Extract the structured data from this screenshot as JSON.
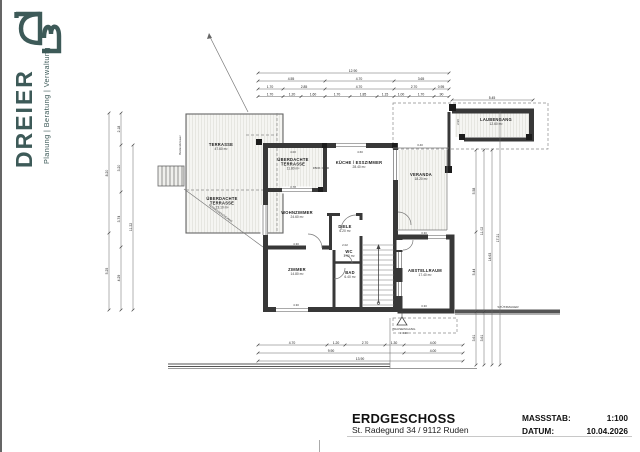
{
  "branding": {
    "name": "DREIER",
    "tagline": "Planung | Beratung | Verwaltung",
    "logo_monogram": "D3",
    "accent_color": "#3d5a58"
  },
  "titleblock": {
    "title": "ERDGESCHOSS",
    "address": "St. Radegund 34 / 9112 Ruden",
    "scale_label": "MASSSTAB:",
    "scale_value": "1:100",
    "date_label": "DATUM:",
    "date_value": "10.04.2026"
  },
  "colors": {
    "wall_line": "#383838",
    "dim_line": "#666666",
    "deck_fill": "#f5f5f2"
  },
  "plan": {
    "rooms": [
      {
        "lines": [
          "TERRASSE"
        ],
        "area": "47.60 m²",
        "x": 221,
        "y": 146
      },
      {
        "lines": [
          "ÜBERDACHTE",
          "TERRASSE"
        ],
        "area": "23.10 m²",
        "x": 222,
        "y": 200
      },
      {
        "lines": [
          "ÜBERDACHTE",
          "TERRASSE"
        ],
        "area": "11.80 m²",
        "x": 293,
        "y": 161
      },
      {
        "lines": [
          "KÜCHE / ESSZIMMER"
        ],
        "area": "28.40 m²",
        "x": 359,
        "y": 164
      },
      {
        "lines": [
          "VERANDA"
        ],
        "area": "18.20 m²",
        "x": 421,
        "y": 176
      },
      {
        "lines": [
          "LAUBENGANG"
        ],
        "area": "12.60 m²",
        "x": 496,
        "y": 121
      },
      {
        "lines": [
          "WOHNZIMMER"
        ],
        "area": "24.60 m²",
        "x": 297,
        "y": 214
      },
      {
        "lines": [
          "DIELE"
        ],
        "area": "6.20 m²",
        "x": 345,
        "y": 228
      },
      {
        "lines": [
          "ZIMMER"
        ],
        "area": "14.80 m²",
        "x": 297,
        "y": 271
      },
      {
        "lines": [
          "WC"
        ],
        "area": "1.90 m²",
        "x": 349,
        "y": 253
      },
      {
        "lines": [
          "BAD"
        ],
        "area": "6.40 m²",
        "x": 350,
        "y": 274
      },
      {
        "lines": [
          "ABSTELLRAUM"
        ],
        "area": "17.40 m²",
        "x": 425,
        "y": 272
      }
    ],
    "labels": [
      {
        "t": "4.00",
        "x": 293,
        "y": 153,
        "size": 2.9
      },
      {
        "t": "4.60",
        "x": 360,
        "y": 153,
        "size": 2.9
      },
      {
        "t": "3.78",
        "x": 293,
        "y": 188,
        "size": 2.9
      },
      {
        "t": "4.30",
        "x": 296,
        "y": 245,
        "size": 2.9
      },
      {
        "t": "4.30",
        "x": 296,
        "y": 306,
        "size": 2.9
      },
      {
        "t": "2.02",
        "x": 345,
        "y": 246,
        "size": 2.9
      },
      {
        "t": "3.30",
        "x": 424,
        "y": 234,
        "size": 2.9
      },
      {
        "t": "3.30",
        "x": 424,
        "y": 307,
        "size": 2.9
      },
      {
        "t": "3.40",
        "x": 420,
        "y": 146,
        "size": 2.9
      },
      {
        "t": "2.96",
        "x": 459,
        "y": 122,
        "rot": -90,
        "size": 2.9
      },
      {
        "t": "STÜTZMAUER",
        "x": 508,
        "y": 308,
        "size": 3.1
      },
      {
        "t": "HAUSEINGANG",
        "x": 404,
        "y": 330,
        "size": 3.1
      },
      {
        "t": "± 0.00",
        "x": 404,
        "y": 334,
        "size": 2.9
      },
      {
        "t": "FBOK ± 0.00",
        "x": 321,
        "y": 169,
        "size": 2.8
      },
      {
        "t": "Bestandsmauer",
        "x": 181,
        "y": 145,
        "rot": -90,
        "size": 2.8
      },
      {
        "t": "TERRASSENZUGANG",
        "x": 220,
        "y": 214,
        "rot": 36,
        "size": 2.8
      }
    ],
    "dim_rows": [
      {
        "y": 73,
        "x1": 258,
        "x2": 449,
        "ticks": [
          258,
          449
        ],
        "labels": [
          {
            "t": "12.90",
            "x": 353
          }
        ]
      },
      {
        "y": 81,
        "x1": 258,
        "x2": 449,
        "ticks": [
          258,
          325,
          394,
          449
        ],
        "labels": [
          {
            "t": "4.55",
            "x": 291
          },
          {
            "t": "4.70",
            "x": 359
          },
          {
            "t": "3.65",
            "x": 421
          }
        ]
      },
      {
        "y": 89,
        "x1": 258,
        "x2": 449,
        "ticks": [
          258,
          283,
          325,
          394,
          434,
          449
        ],
        "labels": [
          {
            "t": "1.70",
            "x": 270
          },
          {
            "t": "2.85",
            "x": 304
          },
          {
            "t": "4.70",
            "x": 359
          },
          {
            "t": "2.70",
            "x": 414
          },
          {
            "t": "0.95",
            "x": 441
          }
        ]
      },
      {
        "y": 96.5,
        "x1": 258,
        "x2": 449,
        "ticks": [
          258,
          283,
          301,
          325,
          350,
          377,
          394,
          409,
          434,
          449
        ],
        "labels": [
          {
            "t": "1.70",
            "x": 270
          },
          {
            "t": "1.20",
            "x": 292
          },
          {
            "t": "1.60",
            "x": 313
          },
          {
            "t": "1.70",
            "x": 337
          },
          {
            "t": "1.85",
            "x": 363
          },
          {
            "t": "1.15",
            "x": 385
          },
          {
            "t": "1.00",
            "x": 401
          },
          {
            "t": "1.70",
            "x": 421
          },
          {
            "t": ".90",
            "x": 441
          }
        ]
      },
      {
        "y": 100,
        "x1": 452,
        "x2": 533,
        "ticks": [
          452,
          533
        ],
        "labels": [
          {
            "t": "5.45",
            "x": 492
          }
        ]
      },
      {
        "y": 345,
        "x1": 258,
        "x2": 463,
        "ticks": [
          258,
          327,
          345,
          385,
          404,
          463
        ],
        "labels": [
          {
            "t": "4.70",
            "x": 292
          },
          {
            "t": "1.20",
            "x": 336
          },
          {
            "t": "2.70",
            "x": 365
          },
          {
            "t": "1.30",
            "x": 394
          },
          {
            "t": "4.00",
            "x": 433
          }
        ]
      },
      {
        "y": 353,
        "x1": 258,
        "x2": 463,
        "ticks": [
          258,
          404,
          463
        ],
        "labels": [
          {
            "t": "9.90",
            "x": 331
          },
          {
            "t": "4.00",
            "x": 433
          }
        ]
      },
      {
        "y": 361,
        "x1": 258,
        "x2": 463,
        "ticks": [
          258,
          463
        ],
        "labels": [
          {
            "t": "13.90",
            "x": 360
          }
        ]
      }
    ],
    "dim_cols": [
      {
        "x": 109,
        "y1": 113,
        "y2": 310,
        "ticks": [
          113,
          233,
          310
        ],
        "labels": [
          {
            "t": "8.20",
            "y": 173
          },
          {
            "t": "5.25",
            "y": 271
          }
        ]
      },
      {
        "x": 121,
        "y1": 113,
        "y2": 310,
        "ticks": [
          113,
          145,
          192,
          247,
          310
        ],
        "labels": [
          {
            "t": "2.18",
            "y": 129
          },
          {
            "t": "3.20",
            "y": 168
          },
          {
            "t": "3.74",
            "y": 219
          },
          {
            "t": "4.29",
            "y": 278
          }
        ]
      },
      {
        "x": 133,
        "y1": 145,
        "y2": 310,
        "ticks": [
          145,
          310
        ],
        "labels": [
          {
            "t": "11.22",
            "y": 227
          }
        ]
      },
      {
        "x": 476,
        "y1": 150,
        "y2": 365,
        "ticks": [
          150,
          232,
          312,
          365
        ],
        "labels": [
          {
            "t": "5.58",
            "y": 191
          },
          {
            "t": "5.44",
            "y": 272
          },
          {
            "t": "3.61",
            "y": 338
          }
        ]
      },
      {
        "x": 484,
        "y1": 150,
        "y2": 365,
        "ticks": [
          150,
          312,
          365
        ],
        "labels": [
          {
            "t": "11.02",
            "y": 231
          },
          {
            "t": "3.61",
            "y": 338
          }
        ]
      },
      {
        "x": 492,
        "y1": 150,
        "y2": 365,
        "ticks": [
          150,
          365
        ],
        "labels": [
          {
            "t": "14.63",
            "y": 257
          }
        ]
      },
      {
        "x": 500,
        "y1": 112,
        "y2": 365,
        "ticks": [
          112,
          365
        ],
        "labels": [
          {
            "t": "17.21",
            "y": 238
          }
        ]
      }
    ]
  }
}
